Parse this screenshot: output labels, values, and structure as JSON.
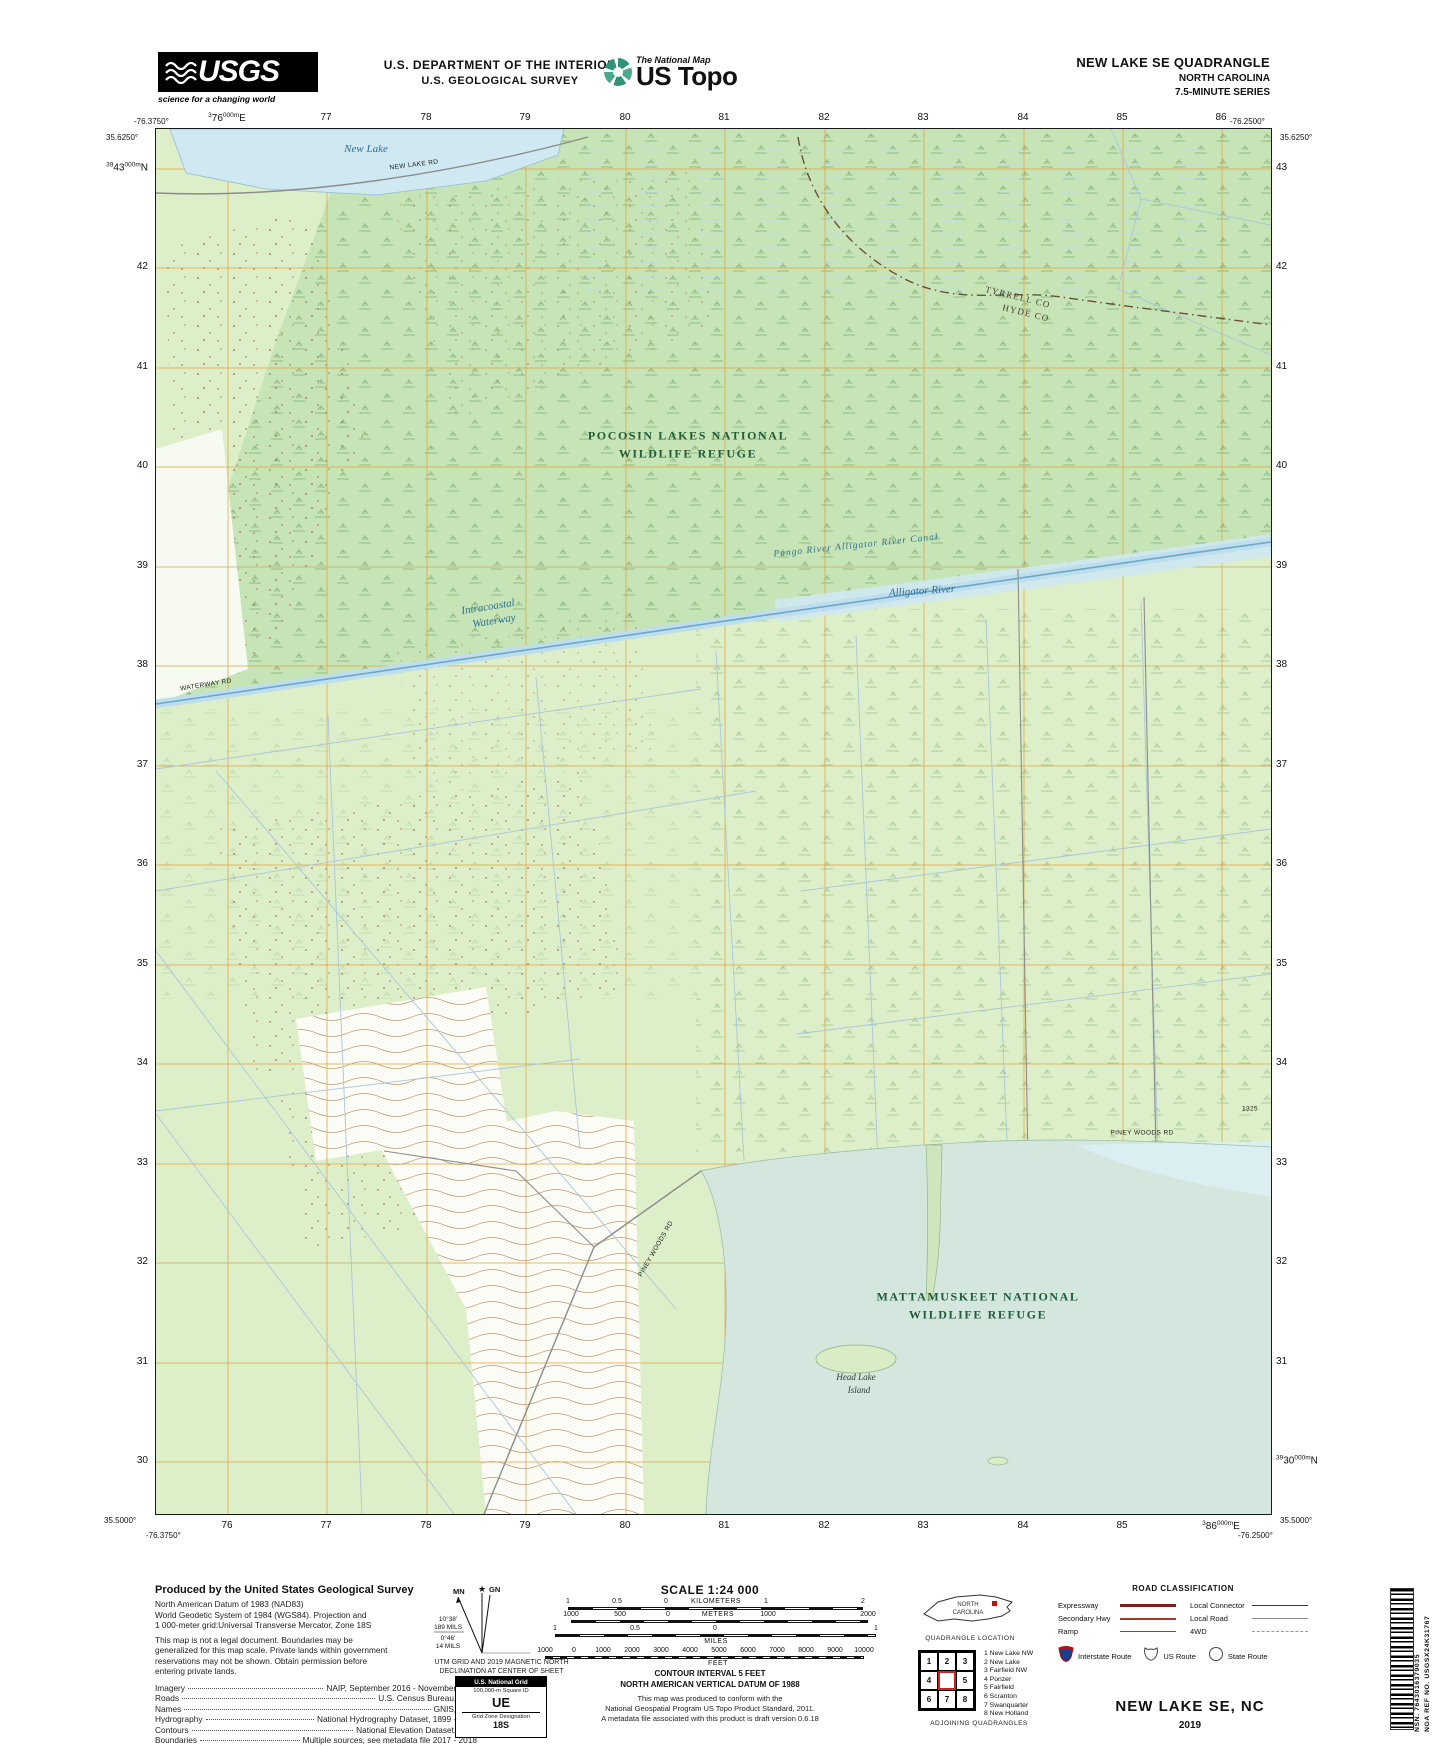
{
  "header": {
    "usgs": {
      "name": "USGS",
      "tagline": "science for a changing world"
    },
    "dept_line1": "U.S. DEPARTMENT OF THE INTERIOR",
    "dept_line2": "U.S. GEOLOGICAL SURVEY",
    "natmap": {
      "small": "The National Map",
      "big": "US Topo"
    },
    "quad_line1": "NEW LAKE SE QUADRANGLE",
    "quad_line2": "NORTH CAROLINA",
    "quad_line3": "7.5-MINUTE SERIES"
  },
  "map": {
    "colors": {
      "land": "#ddefc9",
      "refuge_tint": "#c7e4b6",
      "lake": "#d3e7df",
      "water_line": "#69a8c9",
      "grid": "#e2a23f",
      "contour": "#c09a6e"
    },
    "corners": {
      "tl_lon": "-76.3750°",
      "tl_lat": "35.6250°",
      "tr_lon": "-76.2500°",
      "tr_lat": "35.6250°",
      "bl_lat": "35.5000°",
      "bl_lon": "-76.3750°",
      "br_lat": "35.5000°",
      "br_lon": "-76.2500°"
    },
    "grid": {
      "xs": [
        72,
        171,
        271,
        370,
        470,
        569,
        669,
        768,
        868,
        967,
        1066
      ],
      "ys": [
        40,
        139,
        239,
        338,
        438,
        537,
        637,
        736,
        836,
        935,
        1035,
        1134,
        1234,
        1333
      ],
      "top": [
        "^3^76^000m^E",
        "77",
        "78",
        "79",
        "80",
        "81",
        "82",
        "83",
        "84",
        "85",
        "86"
      ],
      "bottom": [
        "76",
        "77",
        "78",
        "79",
        "80",
        "81",
        "82",
        "83",
        "84",
        "85",
        "^3^86^000m^E"
      ],
      "left": [
        "^39^43^000m^N",
        "42",
        "41",
        "40",
        "39",
        "38",
        "37",
        "36",
        "35",
        "34",
        "33",
        "32",
        "31",
        "30"
      ],
      "right": [
        "43",
        "42",
        "41",
        "40",
        "39",
        "38",
        "37",
        "36",
        "35",
        "34",
        "33",
        "32",
        "31",
        "^39^30^000m^N"
      ]
    },
    "labels": [
      {
        "t": "New Lake",
        "x": 210,
        "y": 20,
        "c": "lbl-water"
      },
      {
        "t": "NEW LAKE RD",
        "x": 258,
        "y": 36,
        "r": -7,
        "c": "lbl-road"
      },
      {
        "t": "POCOSIN LAKES NATIONAL",
        "x": 532,
        "y": 307,
        "c": "lbl-refuge"
      },
      {
        "t": "WILDLIFE REFUGE",
        "x": 532,
        "y": 325,
        "c": "lbl-refuge"
      },
      {
        "t": "TYRRELL CO",
        "x": 862,
        "y": 168,
        "r": 14,
        "c": "lbl-county"
      },
      {
        "t": "HYDE CO",
        "x": 870,
        "y": 184,
        "r": 14,
        "c": "lbl-county"
      },
      {
        "t": "Intracoastal",
        "x": 332,
        "y": 478,
        "r": -9,
        "c": "lbl-water"
      },
      {
        "t": "Waterway",
        "x": 338,
        "y": 492,
        "r": -9,
        "c": "lbl-water"
      },
      {
        "t": "Pungo River Alligator River Canal",
        "x": 700,
        "y": 417,
        "r": -6,
        "c": "lbl-water-sm"
      },
      {
        "t": "Alligator River",
        "x": 766,
        "y": 462,
        "r": -4,
        "c": "lbl-water"
      },
      {
        "t": "WATERWAY RD",
        "x": 50,
        "y": 556,
        "r": -9,
        "c": "lbl-road"
      },
      {
        "t": "PINEY WOODS RD",
        "x": 986,
        "y": 1004,
        "c": "lbl-road"
      },
      {
        "t": "1325",
        "x": 1094,
        "y": 980,
        "c": "lbl-road"
      },
      {
        "t": "PINEY WOODS RD",
        "x": 500,
        "y": 1120,
        "r": -60,
        "c": "lbl-road"
      },
      {
        "t": "MATTAMUSKEET NATIONAL",
        "x": 822,
        "y": 1168,
        "c": "lbl-refuge"
      },
      {
        "t": "WILDLIFE REFUGE",
        "x": 822,
        "y": 1186,
        "c": "lbl-refuge"
      },
      {
        "t": "Head Lake",
        "x": 700,
        "y": 1248,
        "c": "lbl-island"
      },
      {
        "t": "Island",
        "x": 703,
        "y": 1261,
        "c": "lbl-island"
      }
    ]
  },
  "footer": {
    "produced_title": "Produced by the United States Geological Survey",
    "produced_lines": [
      "North American Datum of 1983 (NAD83)",
      "World Geodetic System of 1984 (WGS84).  Projection and",
      "1 000-meter grid:Universal Transverse Mercator, Zone 18S",
      "This map is not a legal document. Boundaries may be",
      "generalized for this map scale. Private lands within government",
      "reservations may not be shown. Obtain permission before",
      "entering private lands."
    ],
    "credits": [
      {
        "k": "Imagery",
        "v": "NAIP, September 2016 - November 2016"
      },
      {
        "k": "Roads",
        "v": "U.S. Census Bureau, 2016"
      },
      {
        "k": "Names",
        "v": "GNIS, 1980"
      },
      {
        "k": "Hydrography",
        "v": "National Hydrography Dataset, 1899 - 2018"
      },
      {
        "k": "Contours",
        "v": "National Elevation Dataset, 2015"
      },
      {
        "k": "Boundaries",
        "v": "Multiple sources; see metadata file 2017 - 2018"
      },
      {
        "k": "Wetlands",
        "v": "FWS National Wetlands Inventory 1998 - 2010"
      }
    ],
    "declination": {
      "mn": "MN",
      "gn": "GN",
      "angle1": "10°38'",
      "mils1": "189 MILS",
      "angle2": "0°46'",
      "mils2": "14 MILS",
      "caption1": "UTM GRID AND 2019 MAGNETIC NORTH",
      "caption2": "DECLINATION AT CENTER OF SHEET"
    },
    "usng": {
      "title": "U.S. National Grid",
      "sub": "100,000-m Square ID",
      "square": "UE",
      "zone_label": "Grid Zone Designation",
      "zone": "18S"
    },
    "scale_title": "SCALE 1:24 000",
    "bars": [
      {
        "unit": "KILOMETERS",
        "row_y": 0,
        "unit_x": 196,
        "unit_below": false,
        "bar": {
          "x": 48,
          "w": 295,
          "fine": false
        },
        "ticks": [
          {
            "t": "1",
            "x": 48
          },
          {
            "t": "0.5",
            "x": 97
          },
          {
            "t": "0",
            "x": 146
          },
          {
            "t": "1",
            "x": 246
          },
          {
            "t": "2",
            "x": 343
          }
        ]
      },
      {
        "unit": "METERS",
        "row_y": 13,
        "unit_x": 198,
        "unit_below": false,
        "bar": {
          "x": 51,
          "w": 297,
          "fine": false
        },
        "ticks": [
          {
            "t": "1000",
            "x": 51
          },
          {
            "t": "500",
            "x": 100
          },
          {
            "t": "0",
            "x": 148
          },
          {
            "t": "1000",
            "x": 248
          },
          {
            "t": "2000",
            "x": 348
          }
        ]
      },
      {
        "unit": "MILES",
        "row_y": 27,
        "unit_x": 196,
        "unit_below": true,
        "bar": {
          "x": 35,
          "w": 321,
          "fine": false
        },
        "ticks": [
          {
            "t": "1",
            "x": 35
          },
          {
            "t": "0.5",
            "x": 115
          },
          {
            "t": "0",
            "x": 195
          },
          {
            "t": "1",
            "x": 356
          }
        ]
      },
      {
        "unit": "FEET",
        "row_y": 49,
        "unit_x": 198,
        "unit_below": true,
        "bar": {
          "x": 25,
          "w": 319,
          "fine": true
        },
        "ticks": [
          {
            "t": "1000",
            "x": 25
          },
          {
            "t": "0",
            "x": 54
          },
          {
            "t": "1000",
            "x": 83
          },
          {
            "t": "2000",
            "x": 112
          },
          {
            "t": "3000",
            "x": 141
          },
          {
            "t": "4000",
            "x": 170
          },
          {
            "t": "5000",
            "x": 199
          },
          {
            "t": "6000",
            "x": 228
          },
          {
            "t": "7000",
            "x": 257
          },
          {
            "t": "8000",
            "x": 286
          },
          {
            "t": "9000",
            "x": 315
          },
          {
            "t": "10000",
            "x": 344
          }
        ]
      }
    ],
    "contour_line1": "CONTOUR INTERVAL 5 FEET",
    "contour_line2": "NORTH AMERICAN VERTICAL DATUM OF 1988",
    "conform": [
      "This map was produced to conform with the",
      "National Geospatial Program US Topo Product Standard, 2011.",
      "A metadata file associated with this product is draft version 0.6.18"
    ],
    "location": {
      "state1": "NORTH",
      "state2": "CAROLINA",
      "caption": "QUADRANGLE LOCATION"
    },
    "adjoining": {
      "cells": [
        "1",
        "2",
        "3",
        "4",
        "",
        "5",
        "6",
        "7",
        "8"
      ],
      "names": [
        "1 New Lake NW",
        "2 New Lake",
        "3 Fairfield NW",
        "4 Ponzer",
        "5 Fairfield",
        "6 Scranton",
        "7 Swanquarter",
        "8 New Holland"
      ],
      "caption": "ADJOINING QUADRANGLES"
    },
    "road_class": {
      "title": "ROAD CLASSIFICATION",
      "left": [
        {
          "label": "Expressway",
          "cls": "expressway"
        },
        {
          "label": "Secondary Hwy",
          "cls": "secondary"
        },
        {
          "label": "Ramp",
          "cls": "ramp"
        }
      ],
      "right": [
        {
          "label": "Local Connector",
          "cls": "connector"
        },
        {
          "label": "Local Road",
          "cls": "localroad"
        },
        {
          "label": "4WD",
          "cls": "fourwd"
        }
      ],
      "shields": [
        {
          "label": "Interstate Route",
          "type": "interstate"
        },
        {
          "label": "US Route",
          "type": "us"
        },
        {
          "label": "State Route",
          "type": "state"
        }
      ]
    },
    "title_block": {
      "title": "NEW LAKE SE,  NC",
      "year": "2019"
    },
    "barcode": {
      "nsn": "NSN. 7643016379035",
      "ref": "NGA REF NO. USGSX24K31767"
    }
  }
}
